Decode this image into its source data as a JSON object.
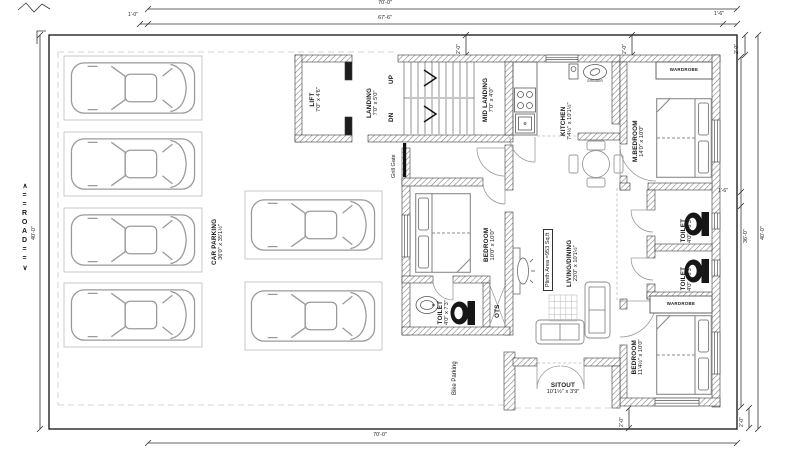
{
  "road_label": "∧==ROAD==∨",
  "dims": {
    "width_total": "70'-0\"",
    "width_inner": "67'-6\"",
    "offset_1_0": "1'-0\"",
    "offset_1_6": "1'-6\"",
    "offset_2_0": "2'-0\"",
    "height_total": "40'-0\"",
    "height_inner": "36'-0\""
  },
  "rooms": {
    "car_parking": {
      "name": "CAR PARKING",
      "size": "36'0\" x 35'1½\""
    },
    "lift": {
      "name": "LIFT",
      "size": "7'0\" x 4'6\""
    },
    "landing": {
      "name": "LANDING",
      "size": "7'0\" x 5'0\""
    },
    "mid_landing": {
      "name": "MID LANDING",
      "size": "7'0\" x 4'0\""
    },
    "kitchen": {
      "name": "KITCHEN",
      "size": "7'4½\" x 10'1½\""
    },
    "m_bedroom": {
      "name": "M.BEDROOM",
      "size": "14'0\" x 10'0\""
    },
    "toilet_small": {
      "name": "TOILET",
      "size": "4'0\" x 6'3\""
    },
    "toilet_left": {
      "name": "TOILET",
      "size": "4'0\" x 7'3\""
    },
    "bedroom_right": {
      "name": "BEDROOM",
      "size": "11'4½\" x 10'0\""
    },
    "bedroom_left": {
      "name": "BEDROOM",
      "size": "10'0\" x 10'0\""
    },
    "living": {
      "name": "LIVING/DINING",
      "size": "23'0\" x 10'1½\""
    },
    "sitout": {
      "name": "SITOUT",
      "size": "10'1½\" x 3'9\""
    },
    "ots": {
      "name": "OTS"
    },
    "wardrobe": {
      "name": "WARDROBE"
    },
    "grill_gate": {
      "name": "Grill Gate"
    },
    "bike_parking": {
      "name": "Bike Parking"
    },
    "grinder": {
      "name": "GRINDER"
    },
    "up": "UP",
    "dn": "DN"
  },
  "annotations": {
    "plinth_area": "Plinth Area =953 Sq.ft"
  }
}
